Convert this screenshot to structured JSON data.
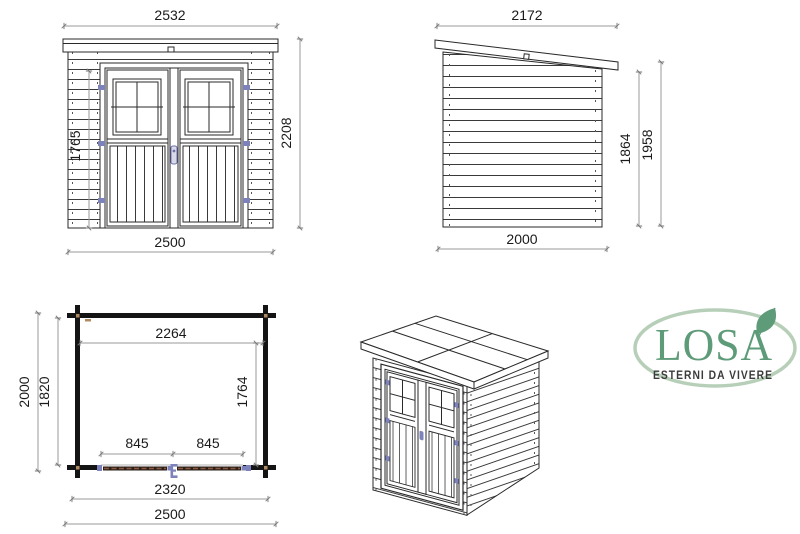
{
  "front_view": {
    "width_top": "2532",
    "width_bottom": "2500",
    "height_total": "2208",
    "height_door": "1765"
  },
  "side_view": {
    "width_top": "2172",
    "width_bottom": "2000",
    "height_wall": "1864",
    "height_total": "1958"
  },
  "floor_plan": {
    "width_inner": "2264",
    "depth_outer": "2000",
    "depth_inner": "1820",
    "depth_door_to_wall": "1764",
    "door_half_left": "845",
    "door_half_right": "845",
    "width_base": "2320",
    "width_outer": "2500"
  },
  "logo": {
    "brand": "LOSA",
    "tagline": "ESTERNI DA VIVERE"
  },
  "colors": {
    "drawing_line": "#2a2a2a",
    "dimension_line": "#9a9a9a",
    "dimension_text": "#1a1a1a",
    "hardware_blue": "#7e82ba",
    "logo_green": "#5e9b79",
    "logo_ellipse_green": "#b7cfb9",
    "tagline_gray": "#3b3b3b",
    "plan_wall_black": "#141414",
    "plan_door_wood": "#8a5a40"
  }
}
